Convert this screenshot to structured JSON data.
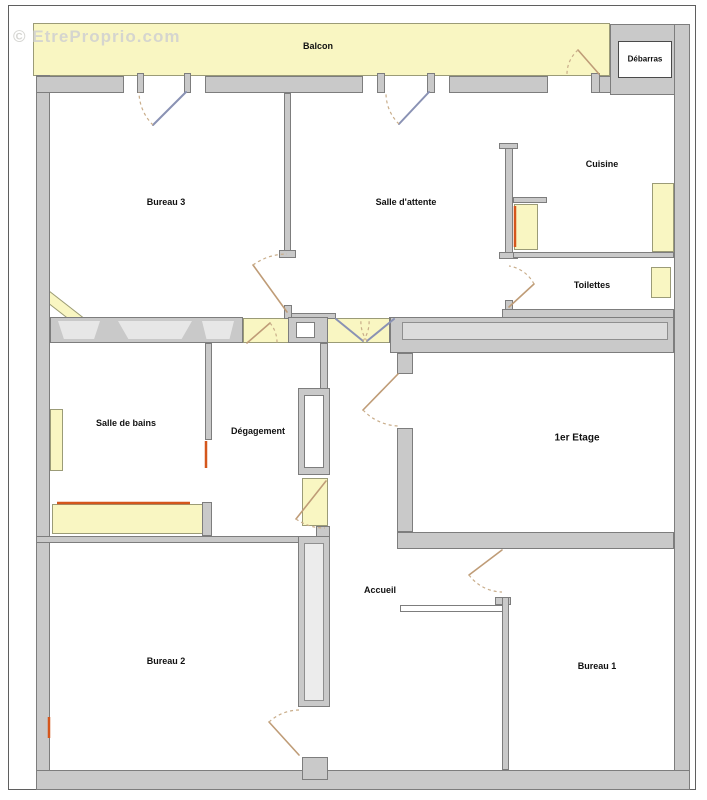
{
  "watermark": "© EtreProprio.com",
  "rooms": {
    "balcon": "Balcon",
    "debarras": "Débarras",
    "bureau3": "Bureau 3",
    "salle_attente": "Salle d'attente",
    "cuisine": "Cuisine",
    "toilettes": "Toilettes",
    "salle_de_bains": "Salle de bains",
    "degagement": "Dégagement",
    "etage": "1er Etage",
    "accueil": "Accueil",
    "bureau2": "Bureau 2",
    "bureau1": "Bureau 1"
  },
  "colors": {
    "wall": "#c9c9c9",
    "wall_outline": "#7d7d7d",
    "window_highlight": "#f9f6c2",
    "radiator_accent": "#d4561c",
    "door_panel_glazed": "#8a92b4",
    "door_panel_wood": "#bf9c77",
    "door_swing_dash": "#c9ad8a"
  }
}
